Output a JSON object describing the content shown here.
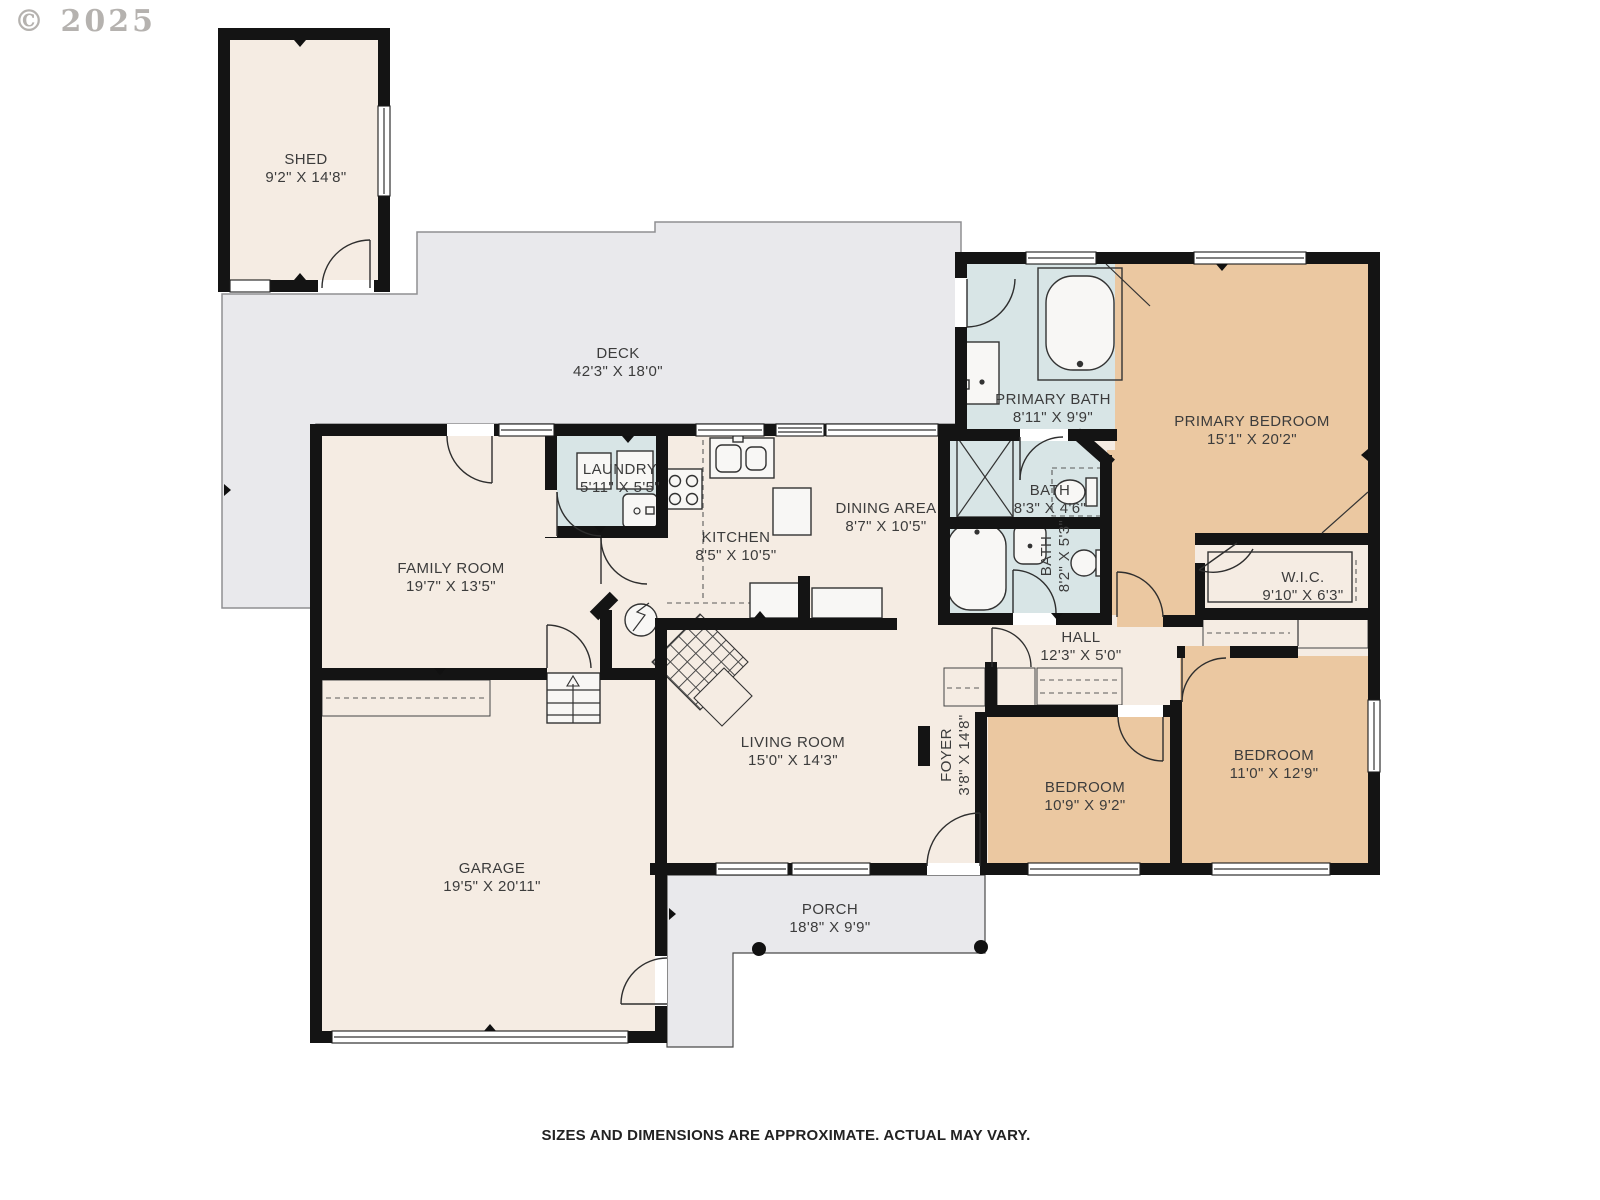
{
  "watermark": "© 2025",
  "footer": "SIZES AND DIMENSIONS ARE APPROXIMATE. ACTUAL MAY VARY.",
  "colors": {
    "wall": "#141414",
    "room": "#f5ece3",
    "bedroom": "#ebc8a1",
    "bath": "#d8e5e6",
    "outdoor": "#e9e9ec",
    "fixture": "#f8f7f5",
    "line": "#333333",
    "label": "#3c3c3c"
  },
  "rooms": [
    {
      "id": "shed",
      "name": "SHED",
      "dims": "9'2\" X 14'8\"",
      "cx": 306,
      "cy": 169,
      "vertical": false
    },
    {
      "id": "deck",
      "name": "DECK",
      "dims": "42'3\" X 18'0\"",
      "cx": 618,
      "cy": 363,
      "vertical": false
    },
    {
      "id": "family-room",
      "name": "FAMILY ROOM",
      "dims": "19'7\" X 13'5\"",
      "cx": 451,
      "cy": 578,
      "vertical": false
    },
    {
      "id": "laundry",
      "name": "LAUNDRY",
      "dims": "5'11\" X 5'5\"",
      "cx": 620,
      "cy": 479,
      "vertical": false
    },
    {
      "id": "kitchen",
      "name": "KITCHEN",
      "dims": "8'5\" X 10'5\"",
      "cx": 736,
      "cy": 547,
      "vertical": false
    },
    {
      "id": "dining-area",
      "name": "DINING AREA",
      "dims": "8'7\" X 10'5\"",
      "cx": 886,
      "cy": 518,
      "vertical": false
    },
    {
      "id": "primary-bath",
      "name": "PRIMARY BATH",
      "dims": "8'11\" X 9'9\"",
      "cx": 1053,
      "cy": 409,
      "vertical": false
    },
    {
      "id": "primary-bedroom",
      "name": "PRIMARY BEDROOM",
      "dims": "15'1\" X 20'2\"",
      "cx": 1252,
      "cy": 431,
      "vertical": false
    },
    {
      "id": "bath-upper",
      "name": "BATH",
      "dims": "8'3\" X 4'6\"",
      "cx": 1050,
      "cy": 500,
      "vertical": false
    },
    {
      "id": "bath-lower",
      "name": "BATH",
      "dims": "8'2\" X 5'3\"",
      "cx": 1056,
      "cy": 556,
      "vertical": true
    },
    {
      "id": "wic",
      "name": "W.I.C.",
      "dims": "9'10\" X 6'3\"",
      "cx": 1303,
      "cy": 587,
      "vertical": false
    },
    {
      "id": "hall",
      "name": "HALL",
      "dims": "12'3\" X 5'0\"",
      "cx": 1081,
      "cy": 647,
      "vertical": false
    },
    {
      "id": "living-room",
      "name": "LIVING ROOM",
      "dims": "15'0\" X 14'3\"",
      "cx": 793,
      "cy": 752,
      "vertical": false
    },
    {
      "id": "foyer",
      "name": "FOYER",
      "dims": "3'8\" X 14'8\"",
      "cx": 956,
      "cy": 755,
      "vertical": true
    },
    {
      "id": "bedroom-left",
      "name": "BEDROOM",
      "dims": "10'9\" X 9'2\"",
      "cx": 1085,
      "cy": 797,
      "vertical": false
    },
    {
      "id": "bedroom-right",
      "name": "BEDROOM",
      "dims": "11'0\" X 12'9\"",
      "cx": 1274,
      "cy": 765,
      "vertical": false
    },
    {
      "id": "garage",
      "name": "GARAGE",
      "dims": "19'5\" X 20'11\"",
      "cx": 492,
      "cy": 878,
      "vertical": false
    },
    {
      "id": "porch",
      "name": "PORCH",
      "dims": "18'8\" X 9'9\"",
      "cx": 830,
      "cy": 919,
      "vertical": false
    }
  ]
}
